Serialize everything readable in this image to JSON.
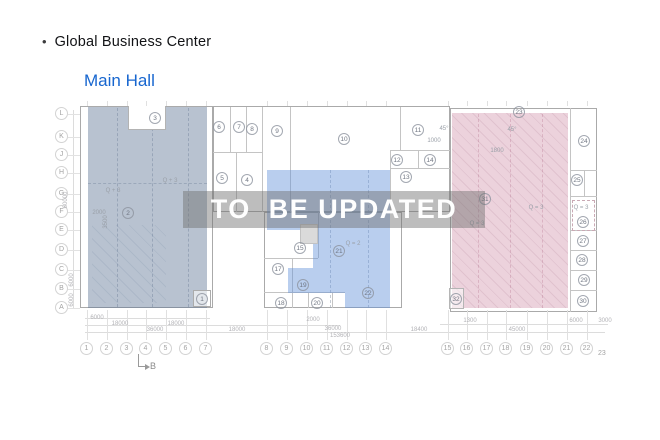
{
  "header": {
    "bullet": "•",
    "title": "Global Business Center",
    "subtitle": "Main Hall",
    "subtitle_color": "#1766cf",
    "title_color": "#121316"
  },
  "watermark": {
    "text": "TO  BE UPDATED",
    "band_color": "#707070",
    "text_color": "#ffffff"
  },
  "plan": {
    "zone_colors": {
      "left_zone": "#b8c2d0",
      "middle_zone": "#b9ceee",
      "right_zone": "#ecd2dc"
    },
    "section_mark": "B",
    "row_axis": [
      {
        "n": "L",
        "y": 114
      },
      {
        "n": "K",
        "y": 137
      },
      {
        "n": "J",
        "y": 155
      },
      {
        "n": "H",
        "y": 173
      },
      {
        "n": "G",
        "y": 194
      },
      {
        "n": "F",
        "y": 212
      },
      {
        "n": "E",
        "y": 230
      },
      {
        "n": "D",
        "y": 250
      },
      {
        "n": "C",
        "y": 270
      },
      {
        "n": "B",
        "y": 289
      },
      {
        "n": "A",
        "y": 308
      }
    ],
    "col_axis": [
      {
        "n": "1",
        "x": 87
      },
      {
        "n": "2",
        "x": 107
      },
      {
        "n": "3",
        "x": 127
      },
      {
        "n": "4",
        "x": 146
      },
      {
        "n": "5",
        "x": 166
      },
      {
        "n": "6",
        "x": 186
      },
      {
        "n": "7",
        "x": 206
      },
      {
        "n": "8",
        "x": 267
      },
      {
        "n": "9",
        "x": 287
      },
      {
        "n": "10",
        "x": 307
      },
      {
        "n": "11",
        "x": 327
      },
      {
        "n": "12",
        "x": 347
      },
      {
        "n": "13",
        "x": 366
      },
      {
        "n": "14",
        "x": 386
      },
      {
        "n": "15",
        "x": 448
      },
      {
        "n": "16",
        "x": 467
      },
      {
        "n": "17",
        "x": 487
      },
      {
        "n": "18",
        "x": 506
      },
      {
        "n": "19",
        "x": 527
      },
      {
        "n": "20",
        "x": 547
      },
      {
        "n": "21",
        "x": 567
      },
      {
        "n": "22",
        "x": 587
      },
      {
        "n": "23",
        "x": 602,
        "small": true
      }
    ],
    "rooms": [
      {
        "n": "1",
        "x": 202,
        "y": 299
      },
      {
        "n": "2",
        "x": 128,
        "y": 213
      },
      {
        "n": "3",
        "x": 155,
        "y": 118
      },
      {
        "n": "4",
        "x": 247,
        "y": 180
      },
      {
        "n": "5",
        "x": 222,
        "y": 178
      },
      {
        "n": "6",
        "x": 219,
        "y": 127
      },
      {
        "n": "7",
        "x": 239,
        "y": 127
      },
      {
        "n": "8",
        "x": 252,
        "y": 129
      },
      {
        "n": "9",
        "x": 277,
        "y": 131
      },
      {
        "n": "10",
        "x": 344,
        "y": 139
      },
      {
        "n": "11",
        "x": 418,
        "y": 130
      },
      {
        "n": "12",
        "x": 397,
        "y": 160
      },
      {
        "n": "13",
        "x": 406,
        "y": 177
      },
      {
        "n": "14",
        "x": 430,
        "y": 160
      },
      {
        "n": "15",
        "x": 300,
        "y": 248
      },
      {
        "n": "17",
        "x": 278,
        "y": 269
      },
      {
        "n": "18",
        "x": 281,
        "y": 303
      },
      {
        "n": "19",
        "x": 303,
        "y": 285
      },
      {
        "n": "20",
        "x": 317,
        "y": 303
      },
      {
        "n": "21",
        "x": 339,
        "y": 251
      },
      {
        "n": "22",
        "x": 368,
        "y": 293
      },
      {
        "n": "23",
        "x": 519,
        "y": 112
      },
      {
        "n": "24",
        "x": 584,
        "y": 141
      },
      {
        "n": "25",
        "x": 577,
        "y": 180
      },
      {
        "n": "26",
        "x": 583,
        "y": 222
      },
      {
        "n": "27",
        "x": 583,
        "y": 241
      },
      {
        "n": "28",
        "x": 582,
        "y": 260
      },
      {
        "n": "29",
        "x": 584,
        "y": 280
      },
      {
        "n": "30",
        "x": 583,
        "y": 301
      },
      {
        "n": "31",
        "x": 485,
        "y": 199
      },
      {
        "n": "32",
        "x": 456,
        "y": 299
      }
    ],
    "zone_labels": [
      {
        "t": "Q + 3",
        "x": 170,
        "y": 182
      },
      {
        "t": "Q + 3",
        "x": 113,
        "y": 192
      },
      {
        "t": "2000",
        "x": 99,
        "y": 214
      },
      {
        "t": "3500",
        "x": 106,
        "y": 226,
        "rot": true
      },
      {
        "t": "Q = 2",
        "x": 353,
        "y": 245
      },
      {
        "t": "Q = 3",
        "x": 536,
        "y": 209
      },
      {
        "t": "Q = 3",
        "x": 477,
        "y": 225
      },
      {
        "t": "Q = 3",
        "x": 581,
        "y": 209
      },
      {
        "t": "1800",
        "x": 497,
        "y": 152
      },
      {
        "t": "1000",
        "x": 434,
        "y": 142
      },
      {
        "t": "45°",
        "x": 444,
        "y": 130
      },
      {
        "t": "45°",
        "x": 512,
        "y": 131
      }
    ],
    "dims": [
      {
        "t": "6000",
        "x": 97,
        "y": 318
      },
      {
        "t": "18000",
        "x": 120,
        "y": 324
      },
      {
        "t": "18000",
        "x": 176,
        "y": 324
      },
      {
        "t": "36000",
        "x": 155,
        "y": 330
      },
      {
        "t": "18000",
        "x": 237,
        "y": 330
      },
      {
        "t": "2000",
        "x": 313,
        "y": 320
      },
      {
        "t": "36000",
        "x": 333,
        "y": 329
      },
      {
        "t": "153600",
        "x": 340,
        "y": 336
      },
      {
        "t": "1300",
        "x": 470,
        "y": 321
      },
      {
        "t": "18400",
        "x": 419,
        "y": 330
      },
      {
        "t": "45000",
        "x": 517,
        "y": 330
      },
      {
        "t": "6000",
        "x": 576,
        "y": 321
      },
      {
        "t": "3000",
        "x": 605,
        "y": 321
      }
    ],
    "vdims": [
      {
        "t": "60000",
        "x": 66,
        "y": 200
      },
      {
        "t": "6000",
        "x": 72,
        "y": 280
      },
      {
        "t": "6000",
        "x": 72,
        "y": 300
      }
    ]
  }
}
